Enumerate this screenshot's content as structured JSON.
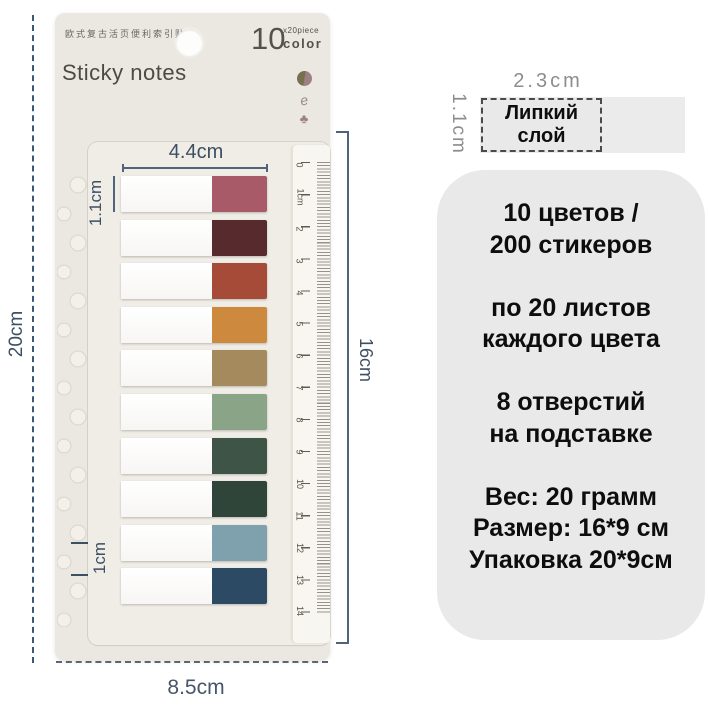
{
  "product_card": {
    "header": {
      "cn_title": "欧式复古活页便利索引贴",
      "count": "10",
      "count_sub_top": "x20piece",
      "count_sub_bottom": "color",
      "title": "Sticky notes",
      "icons": {
        "dot_icon_colors": [
          "#77704f",
          "#9c8084"
        ],
        "squiggle_glyph": "e",
        "clover_glyph": "♣"
      }
    },
    "tabs": [
      {
        "name": "dusty-rose",
        "color": "#a85a68"
      },
      {
        "name": "dark-maroon",
        "color": "#572a2d"
      },
      {
        "name": "rust",
        "color": "#a54b38"
      },
      {
        "name": "mustard",
        "color": "#cd8a3e"
      },
      {
        "name": "khaki",
        "color": "#a58a5d"
      },
      {
        "name": "sage-green",
        "color": "#8aa487"
      },
      {
        "name": "forest-green",
        "color": "#3e5447"
      },
      {
        "name": "deep-green",
        "color": "#2f4539"
      },
      {
        "name": "steel-blue",
        "color": "#7fa1ae"
      },
      {
        "name": "navy",
        "color": "#2d4a64"
      }
    ],
    "ruler_numbers": [
      "0",
      "1cm",
      "2",
      "3",
      "4",
      "5",
      "6",
      "7",
      "8",
      "9",
      "10",
      "11",
      "12",
      "13",
      "14"
    ],
    "dimensions": {
      "tab_width": "4.4cm",
      "tab_height": "1.1cm",
      "card_height": "20cm",
      "tab_pitch": "1cm",
      "ruler_span": "16cm",
      "card_width": "8.5cm"
    }
  },
  "annotation": {
    "sticker_width": "2.3cm",
    "sticker_height": "1.1cm",
    "sticky_layer_label": "Липкий слой",
    "info_lines": [
      "10 цветов /",
      "200 стикеров",
      "",
      "по 20 листов",
      "каждого цвета",
      "",
      "8 отверстий",
      "на подставке",
      "",
      "Вес: 20 грамм",
      "Размер: 16*9 см",
      "Упаковка 20*9см"
    ]
  },
  "colors": {
    "card_bg": "#ebe8e1",
    "stand_bg": "#f0ede7",
    "annotation_blue": "#3d4f63",
    "panel_gray": "#e9e9e9",
    "text_black": "#0d0d0d",
    "text_gray": "#8d8d8d"
  }
}
